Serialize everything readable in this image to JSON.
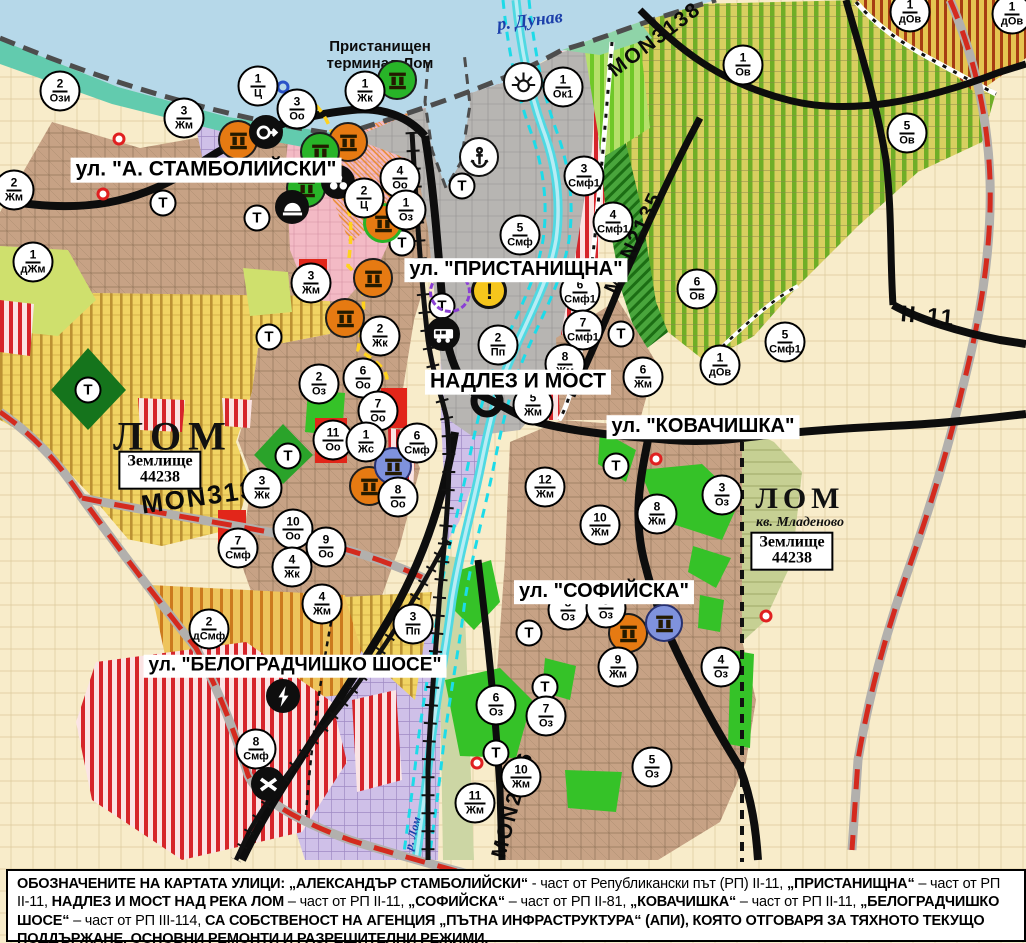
{
  "map": {
    "width": 1026,
    "height": 943,
    "colors": {
      "background_farmland": "#f8ecca",
      "water": "#b6d8e9",
      "shore": "#62cbae",
      "river_lom": "#4fd9e2",
      "road_black": "#0d0d0d",
      "road_red_dash": "#d42a1e",
      "center_boundary_yellow": "#ffd21e",
      "zone_green": "#35c228",
      "zone_red": "#e2261a",
      "zone_lavender": "#cfc0e8",
      "zone_brown": "#c7a285",
      "zone_yellow": "#f1d463",
      "zone_vineyard_stripe": "#6fae27",
      "marker_orange": "#e67a12",
      "marker_green": "#28b428",
      "marker_blue": "#7f92dd"
    },
    "labels": {
      "river": "р. Дунав",
      "river_lom": "р. Лом",
      "terminal_line1": "Пристанищен",
      "terminal_line2": "терминал Лом",
      "city_west": "ЛОМ",
      "city_east": "ЛОМ",
      "district_east": "кв. Младеново",
      "landplot_word": "Землище",
      "landplot_west_number": "44238",
      "landplot_east_number": "44238",
      "t_marker": "Т"
    },
    "street_labels": [
      {
        "id": "stamboliyski",
        "text": "ул. \"А. СТАМБОЛИЙСКИ\"",
        "x": 206,
        "y": 170,
        "fs": 21
      },
      {
        "id": "pristanishtna",
        "text": "ул. \"ПРИСТАНИЩНА\"",
        "x": 516,
        "y": 270,
        "fs": 20
      },
      {
        "id": "nadlez-most",
        "text": "НАДЛЕЗ И МОСТ",
        "x": 518,
        "y": 382,
        "fs": 21
      },
      {
        "id": "kovachishka",
        "text": "ул. \"КОВАЧИШКА\"",
        "x": 703,
        "y": 427,
        "fs": 20
      },
      {
        "id": "sofiyska",
        "text": "ул. \"СОФИЙСКА\"",
        "x": 604,
        "y": 592,
        "fs": 20
      },
      {
        "id": "belogradchishko",
        "text": "ул. \"БЕЛОГРАДЧИШКО ШОСЕ\"",
        "x": 295,
        "y": 666,
        "fs": 19
      }
    ],
    "road_labels": [
      {
        "text": "MON3139",
        "x": 207,
        "y": 496,
        "rot": -8,
        "fs": 26
      },
      {
        "text": "MON3138",
        "x": 655,
        "y": 40,
        "rot": -37,
        "fs": 21
      },
      {
        "text": "MON2135",
        "x": 634,
        "y": 243,
        "rot": -65,
        "fs": 21
      },
      {
        "text": "MON2136",
        "x": 513,
        "y": 805,
        "rot": -75,
        "fs": 21
      },
      {
        "text": "II-11",
        "x": 928,
        "y": 316,
        "rot": 5,
        "fs": 23
      }
    ],
    "zone_markers": [
      {
        "x": 60,
        "y": 91,
        "n": "2",
        "c": "Ози"
      },
      {
        "x": 258,
        "y": 86,
        "n": "1",
        "c": "Ц"
      },
      {
        "x": 297,
        "y": 109,
        "n": "3",
        "c": "Оо"
      },
      {
        "x": 365,
        "y": 91,
        "n": "1",
        "c": "Жк"
      },
      {
        "x": 14,
        "y": 190,
        "n": "2",
        "c": "Жм"
      },
      {
        "x": 184,
        "y": 118,
        "n": "3",
        "c": "Жм"
      },
      {
        "x": 33,
        "y": 262,
        "n": "1",
        "c": "дЖм"
      },
      {
        "x": 400,
        "y": 178,
        "n": "4",
        "c": "Оо"
      },
      {
        "x": 364,
        "y": 198,
        "n": "2",
        "c": "Ц"
      },
      {
        "x": 406,
        "y": 210,
        "n": "1",
        "c": "Оз"
      },
      {
        "x": 311,
        "y": 283,
        "n": "3",
        "c": "Жм"
      },
      {
        "x": 380,
        "y": 336,
        "n": "2",
        "c": "Жк"
      },
      {
        "x": 363,
        "y": 378,
        "n": "6",
        "c": "Оо"
      },
      {
        "x": 319,
        "y": 384,
        "n": "2",
        "c": "Оз"
      },
      {
        "x": 378,
        "y": 411,
        "n": "7",
        "c": "Оо"
      },
      {
        "x": 333,
        "y": 440,
        "n": "11",
        "c": "Оо"
      },
      {
        "x": 366,
        "y": 442,
        "n": "1",
        "c": "Жс"
      },
      {
        "x": 417,
        "y": 443,
        "n": "6",
        "c": "Смф"
      },
      {
        "x": 398,
        "y": 497,
        "n": "8",
        "c": "Оо"
      },
      {
        "x": 262,
        "y": 488,
        "n": "3",
        "c": "Жк"
      },
      {
        "x": 293,
        "y": 529,
        "n": "10",
        "c": "Оо"
      },
      {
        "x": 326,
        "y": 547,
        "n": "9",
        "c": "Оо"
      },
      {
        "x": 238,
        "y": 548,
        "n": "7",
        "c": "Смф"
      },
      {
        "x": 292,
        "y": 567,
        "n": "4",
        "c": "Жк"
      },
      {
        "x": 322,
        "y": 604,
        "n": "4",
        "c": "Жм"
      },
      {
        "x": 209,
        "y": 629,
        "n": "2",
        "c": "дСмф"
      },
      {
        "x": 413,
        "y": 624,
        "n": "3",
        "c": "Пп"
      },
      {
        "x": 256,
        "y": 749,
        "n": "8",
        "c": "Смф"
      },
      {
        "x": 563,
        "y": 87,
        "n": "1",
        "c": "Ок1"
      },
      {
        "x": 584,
        "y": 176,
        "n": "3",
        "c": "Смф1"
      },
      {
        "x": 520,
        "y": 235,
        "n": "5",
        "c": "Смф"
      },
      {
        "x": 613,
        "y": 222,
        "n": "4",
        "c": "Смф1"
      },
      {
        "x": 580,
        "y": 292,
        "n": "6",
        "c": "Смф1"
      },
      {
        "x": 583,
        "y": 330,
        "n": "7",
        "c": "Смф1"
      },
      {
        "x": 565,
        "y": 364,
        "n": "8",
        "c": "Жм"
      },
      {
        "x": 533,
        "y": 405,
        "n": "5",
        "c": "Жм"
      },
      {
        "x": 498,
        "y": 345,
        "n": "2",
        "c": "Пп"
      },
      {
        "x": 643,
        "y": 377,
        "n": "6",
        "c": "Жм"
      },
      {
        "x": 545,
        "y": 487,
        "n": "12",
        "c": "Жм"
      },
      {
        "x": 657,
        "y": 514,
        "n": "8",
        "c": "Жм"
      },
      {
        "x": 600,
        "y": 525,
        "n": "10",
        "c": "Жм"
      },
      {
        "x": 722,
        "y": 495,
        "n": "3",
        "c": "Оз"
      },
      {
        "x": 743,
        "y": 65,
        "n": "1",
        "c": "Ов"
      },
      {
        "x": 907,
        "y": 133,
        "n": "5",
        "c": "Ов"
      },
      {
        "x": 697,
        "y": 289,
        "n": "6",
        "c": "Ов"
      },
      {
        "x": 785,
        "y": 342,
        "n": "5",
        "c": "Смф1"
      },
      {
        "x": 720,
        "y": 365,
        "n": "1",
        "c": "дОв"
      },
      {
        "x": 910,
        "y": 12,
        "n": "1",
        "c": "дОв"
      },
      {
        "x": 1012,
        "y": 14,
        "n": "1",
        "c": "дОв"
      },
      {
        "x": 618,
        "y": 667,
        "n": "9",
        "c": "Жм"
      },
      {
        "x": 721,
        "y": 667,
        "n": "4",
        "c": "Оз"
      },
      {
        "x": 652,
        "y": 767,
        "n": "5",
        "c": "Оз"
      },
      {
        "x": 546,
        "y": 716,
        "n": "7",
        "c": "Оз"
      },
      {
        "x": 496,
        "y": 705,
        "n": "6",
        "c": "Оз"
      },
      {
        "x": 521,
        "y": 777,
        "n": "10",
        "c": "Жм"
      },
      {
        "x": 475,
        "y": 803,
        "n": "11",
        "c": "Жм"
      },
      {
        "x": 568,
        "y": 610,
        "n": "8",
        "c": "Оз"
      },
      {
        "x": 606,
        "y": 608,
        "n": "9",
        "c": "Оз"
      }
    ],
    "t_markers": [
      {
        "x": 163,
        "y": 203
      },
      {
        "x": 257,
        "y": 218
      },
      {
        "x": 88,
        "y": 390
      },
      {
        "x": 269,
        "y": 337
      },
      {
        "x": 288,
        "y": 456
      },
      {
        "x": 402,
        "y": 243
      },
      {
        "x": 442,
        "y": 306
      },
      {
        "x": 462,
        "y": 186
      },
      {
        "x": 621,
        "y": 334
      },
      {
        "x": 616,
        "y": 466
      },
      {
        "x": 529,
        "y": 633
      },
      {
        "x": 545,
        "y": 687
      },
      {
        "x": 496,
        "y": 753
      }
    ],
    "icon_markers": [
      {
        "x": 238,
        "y": 140,
        "type": "ruins",
        "color": "orange"
      },
      {
        "x": 266,
        "y": 132,
        "type": "arrow",
        "color": "black"
      },
      {
        "x": 348,
        "y": 142,
        "type": "ruins",
        "color": "orange"
      },
      {
        "x": 320,
        "y": 152,
        "type": "ruins",
        "color": "green"
      },
      {
        "x": 306,
        "y": 188,
        "type": "ruins",
        "color": "green"
      },
      {
        "x": 338,
        "y": 182,
        "type": "trefoil",
        "color": "black"
      },
      {
        "x": 292,
        "y": 207,
        "type": "tumulus",
        "color": "black"
      },
      {
        "x": 383,
        "y": 223,
        "type": "ruins",
        "color": "orange-green"
      },
      {
        "x": 397,
        "y": 80,
        "type": "ruins",
        "color": "green"
      },
      {
        "x": 373,
        "y": 278,
        "type": "ruins",
        "color": "orange"
      },
      {
        "x": 345,
        "y": 318,
        "type": "ruins",
        "color": "orange"
      },
      {
        "x": 369,
        "y": 486,
        "type": "ruins",
        "color": "orange"
      },
      {
        "x": 393,
        "y": 466,
        "type": "ruins",
        "color": "blue"
      },
      {
        "x": 628,
        "y": 633,
        "type": "ruins",
        "color": "orange"
      },
      {
        "x": 664,
        "y": 623,
        "type": "ruins",
        "color": "blue"
      },
      {
        "x": 443,
        "y": 334,
        "type": "truck",
        "color": "black"
      },
      {
        "x": 479,
        "y": 157,
        "type": "anchor",
        "color": "white"
      },
      {
        "x": 523,
        "y": 82,
        "type": "sun",
        "color": "white"
      },
      {
        "x": 489,
        "y": 291,
        "type": "warning",
        "color": "yellow"
      },
      {
        "x": 283,
        "y": 696,
        "type": "lightning",
        "color": "black"
      },
      {
        "x": 268,
        "y": 784,
        "type": "crossing",
        "color": "black"
      },
      {
        "x": 450,
        "y": 292,
        "type": "dashed-circle",
        "color": "purple"
      },
      {
        "x": 283,
        "y": 87,
        "type": "ring",
        "color": "bluering"
      },
      {
        "x": 119,
        "y": 139,
        "type": "dot",
        "color": "red"
      },
      {
        "x": 103,
        "y": 194,
        "type": "dot",
        "color": "red"
      },
      {
        "x": 656,
        "y": 459,
        "type": "dot",
        "color": "red"
      },
      {
        "x": 477,
        "y": 763,
        "type": "dot",
        "color": "red"
      },
      {
        "x": 766,
        "y": 616,
        "type": "dot",
        "color": "red"
      }
    ],
    "note": {
      "segments": [
        {
          "text": "ОБОЗНАЧЕНИТЕ НА КАРТАТА УЛИЦИ: „АЛЕКСАНДЪР СТАМБОЛИЙСКИ“",
          "bold": true
        },
        {
          "text": " - част от Републикански път (РП) II-11, ",
          "bold": false
        },
        {
          "text": "„ПРИСТАНИЩНА“",
          "bold": true
        },
        {
          "text": " – част от РП II-11, ",
          "bold": false
        },
        {
          "text": "НАДЛЕЗ И МОСТ НАД РЕКА ЛОМ",
          "bold": true
        },
        {
          "text": " – част от РП II-11, ",
          "bold": false
        },
        {
          "text": "„СОФИЙСКА“",
          "bold": true
        },
        {
          "text": " – част от РП II-81, ",
          "bold": false
        },
        {
          "text": "„КОВАЧИШКА“",
          "bold": true
        },
        {
          "text": " – част от РП II-11, ",
          "bold": false
        },
        {
          "text": "„БЕЛОГРАДЧИШКО ШОСЕ“",
          "bold": true
        },
        {
          "text": " – част от РП III-114, ",
          "bold": false
        },
        {
          "text": "СА СОБСТВЕНОСТ НА АГЕНЦИЯ „ПЪТНА ИНФРАСТРУКТУРА“ (АПИ), КОЯТО ОТГОВАРЯ ЗА ТЯХНОТО ТЕКУЩО ПОДДЪРЖАНЕ, ОСНОВНИ РЕМОНТИ И РАЗРЕШИТЕЛНИ РЕЖИМИ.",
          "bold": true
        }
      ]
    }
  }
}
